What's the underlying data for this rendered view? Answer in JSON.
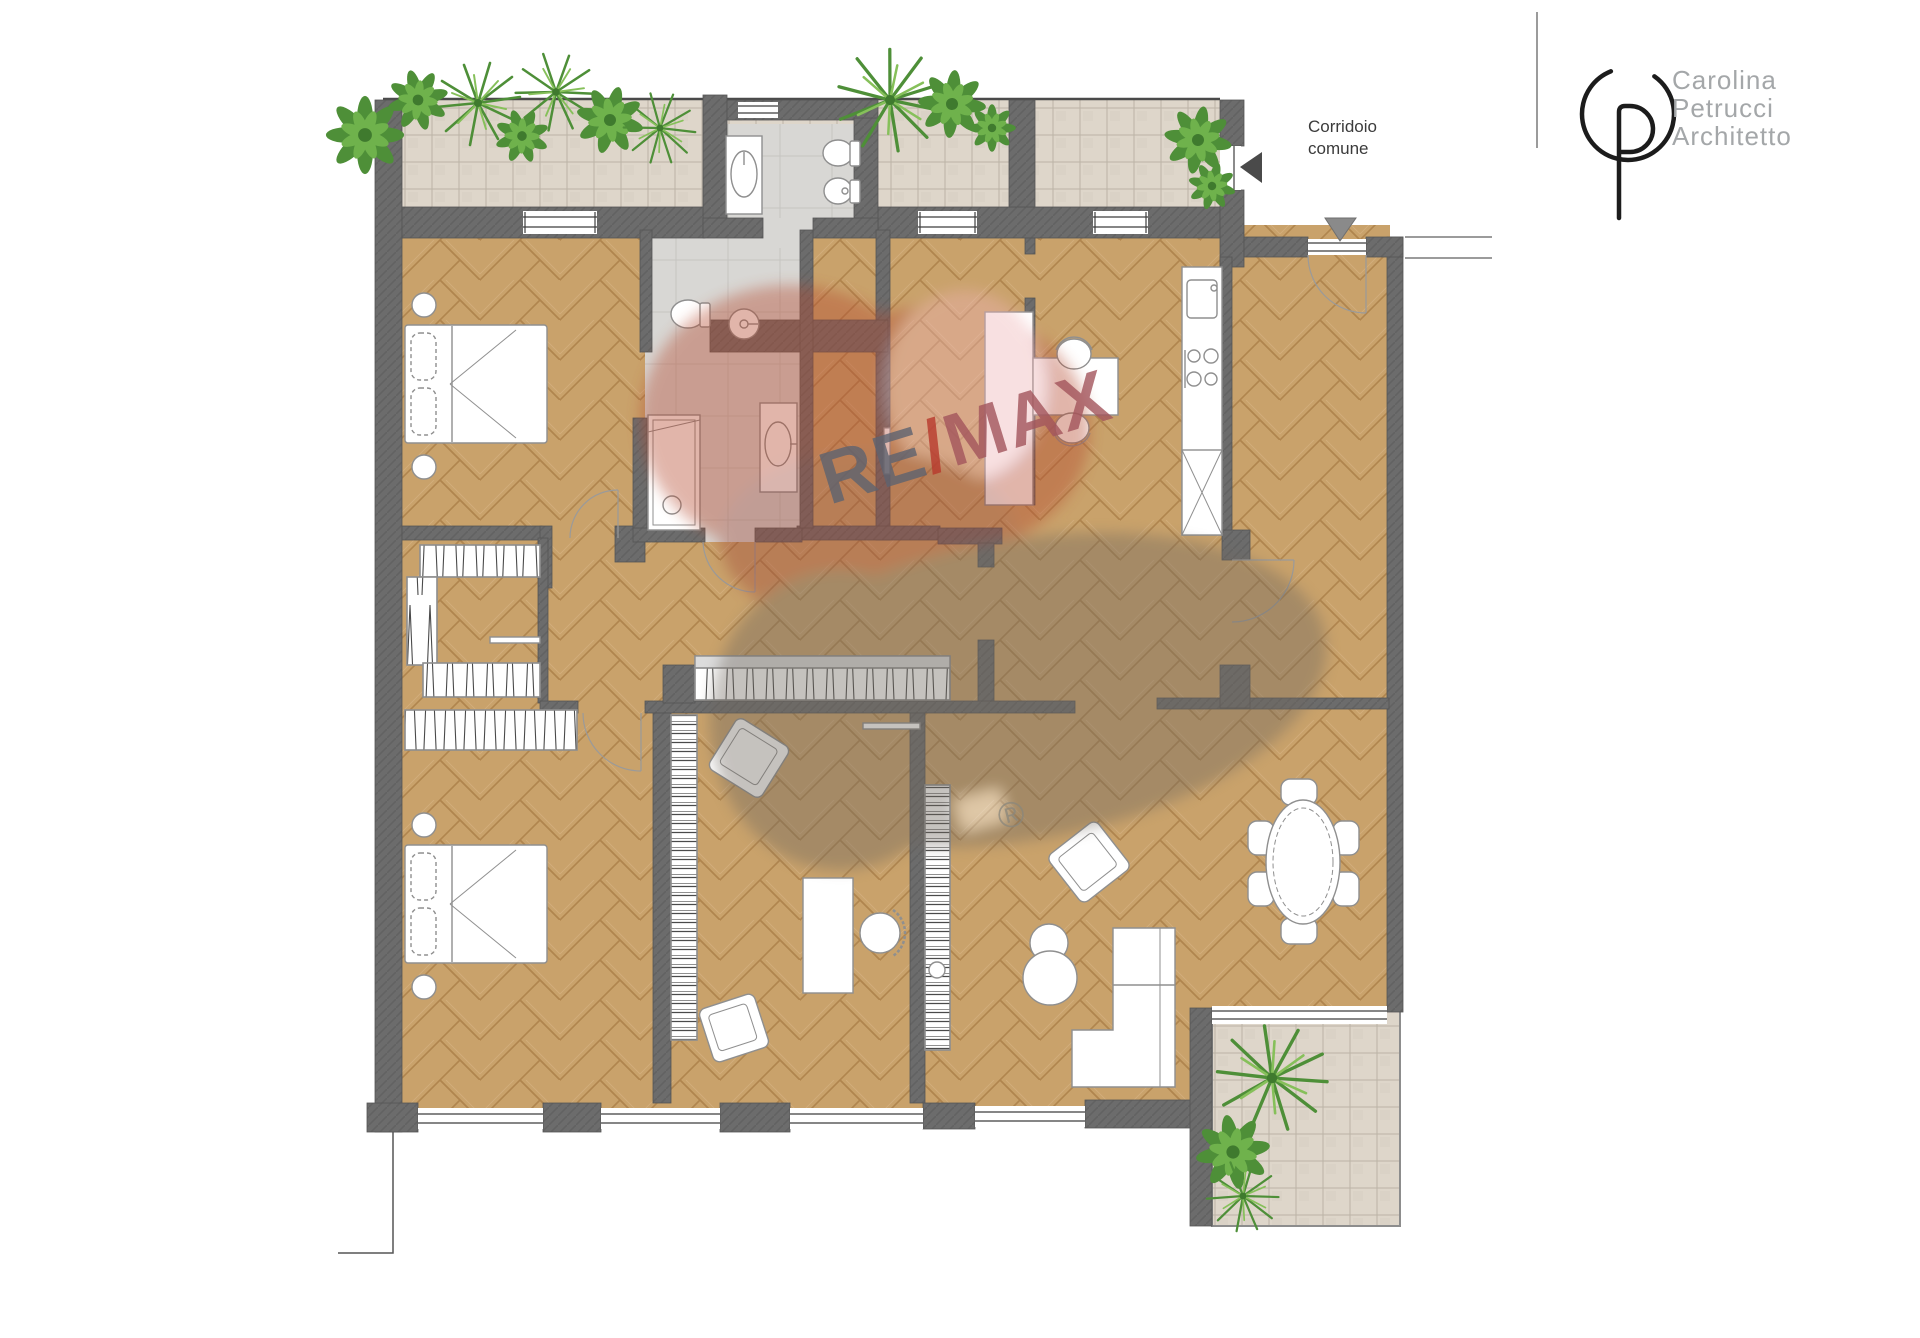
{
  "labels": {
    "corridor_line1": "Corridoio",
    "corridor_line2": "comune"
  },
  "architect_logo": {
    "monogram": "CP",
    "line1": "Carolina",
    "line2": "Petrucci",
    "line3": "Architetto"
  },
  "watermark": {
    "re": "RE",
    "slash": "/",
    "max": "MAX",
    "registered": "®"
  },
  "colors": {
    "wall": "#6c6c6c",
    "parquet": "#c9a26b",
    "parquet_line": "#b0854e",
    "terrace_tile": "#ded6ca",
    "bath_floor": "#d8d7d4",
    "plant_green": "#4e8f38",
    "watermark_red": "#b5492f",
    "watermark_pink": "#efb3b5",
    "watermark_shadow": "#6f685e",
    "corridor_text": "#3b3b3b",
    "architect_text": "#a4a7a9"
  }
}
